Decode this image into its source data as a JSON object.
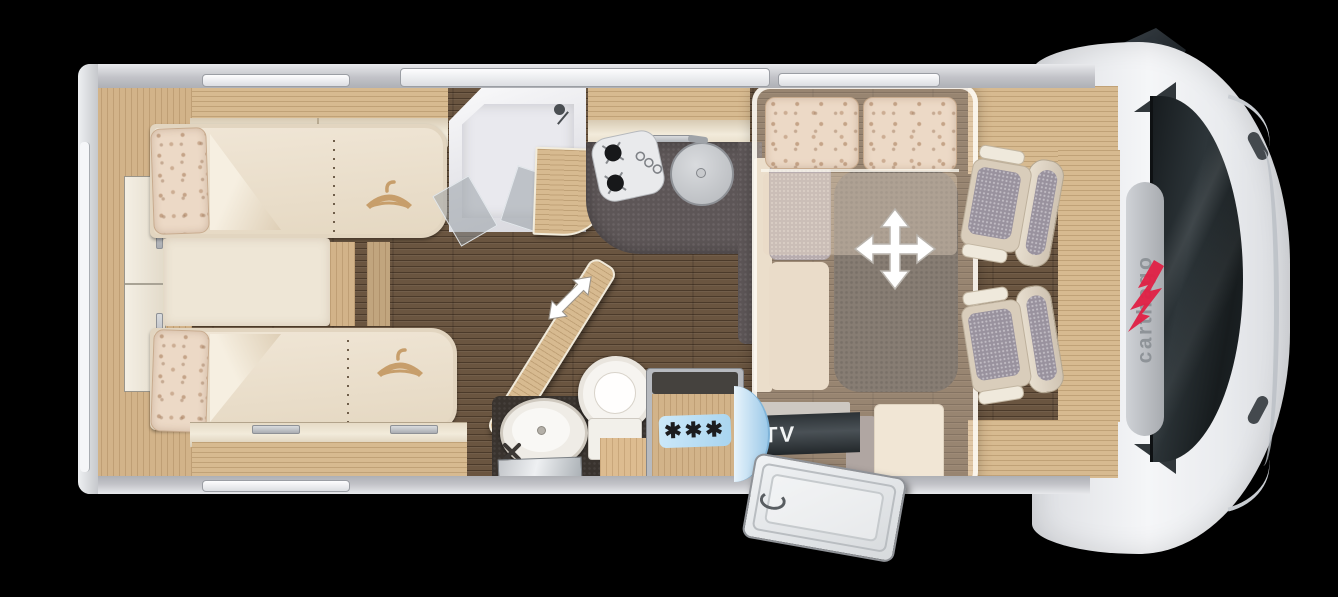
{
  "vehicle": {
    "brand": "carthago"
  },
  "labels": {
    "tv": "TV",
    "fridge_freezer_stars": "✱✱✱"
  },
  "icons": {
    "move_bed_icon": "four-way-arrow",
    "swivel_wall_icon": "diagonal-double-arrow",
    "hanger_icon": "clothes-hanger",
    "hob_icon": "two-burner-hob",
    "sink_icon": "round-sink",
    "washbasin_icon": "oval-washbasin",
    "toilet_icon": "toilet",
    "shower_icon": "corner-shower",
    "side_mirror_icon": "wing-mirror"
  },
  "colors": {
    "background": "#000000",
    "body_white": "#f5f6f8",
    "wall_gray": "#c2c3c8",
    "floor_walnut": "#6a5540",
    "furniture_oak": "#d7ba90",
    "upholstery_cream": "#ece3d0",
    "kitchen_counter": "#5d5657",
    "rug_gray": "#6b635d",
    "freezer_label_blue": "#a8d4ef",
    "tv_panel": "#2c3236",
    "brand_red": "#e02045",
    "brand_gray": "#8e9398",
    "door_glass_blue": "#9cc9e8"
  }
}
